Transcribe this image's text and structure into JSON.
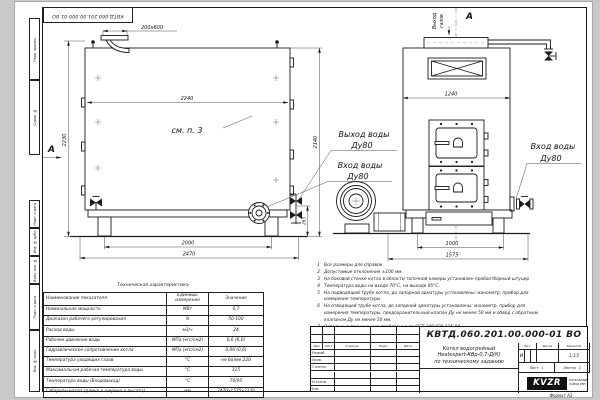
{
  "sheet": {
    "designation_top": "КВТД.060.201.00.000-01 ВО",
    "format_note": "Формат А3",
    "margin_labels": [
      "Перв. примен.",
      "Справ. №",
      "Подп. и дата",
      "Инв. № дубл.",
      "Взам. инв. №",
      "Подп. и дата",
      "Инв. № подл."
    ]
  },
  "side_view": {
    "dim_chimney": "200x600",
    "dim_width": "2240",
    "dim_height": "2230",
    "dim_outlet_height": "2140",
    "dim_valve_height": "263",
    "dim_legs": "2000",
    "dim_length": "2470",
    "see_item": "см. п. 3",
    "view_arrow": "А"
  },
  "front_view": {
    "view_label": "А",
    "gas_out_line1": "Выход",
    "gas_out_line2": "газов",
    "dim_width": "1240",
    "dim_legs": "1000",
    "dim_overall": "1575",
    "label_water_out": "Выход воды",
    "label_water_out_dn": "Ду80",
    "label_water_in": "Вход воды",
    "label_water_in_dn": "Ду80",
    "label_water_in_right": "Вход воды",
    "label_water_in_right_dn": "Ду80"
  },
  "notes": [
    {
      "n": "1",
      "text": "Все размеры для справок"
    },
    {
      "n": "2",
      "text": "Допустимые отклонения ±100 мм."
    },
    {
      "n": "3",
      "text": "На боковой стенке котла в области топочной камеры установлен пробоотборный штуцер"
    },
    {
      "n": "4",
      "text": "Температура воды на входе 70°С, на выходе 95°С."
    },
    {
      "n": "5",
      "text": "На подводящей трубе котла, до запорной арматуры установлены: манометр, прибор для измерения температуры"
    },
    {
      "n": "6",
      "text": "На отводящей трубе котла, до запорной арматуры установлены: манометр, прибор для измерения температуры, предохранительный клапан Ду не менее 50 мм и обвод с обратным клапаном Ду не менее 50 мм."
    },
    {
      "n": "7",
      "text": "Остальные технические требования по ОСТ 108.030.135-84."
    }
  ],
  "table": {
    "title": "Техническая характеристика",
    "headers": [
      "Наименование показателя",
      "Единицы измерения",
      "Значение"
    ],
    "rows": [
      [
        "Номинальная мощность",
        "МВт",
        "0,7"
      ],
      [
        "Диапазон рабочего регулирования",
        "%",
        "50-100"
      ],
      [
        "Расход воды",
        "м3/ч",
        "24"
      ],
      [
        "Рабочее давление воды",
        "МПа (кгс/см2)",
        "0,6 (6,0)"
      ],
      [
        "Гидравлическое сопротивление котла",
        "МПа (кгс/см2)",
        "0,06 (0,6)"
      ],
      [
        "Температура уходящих газов",
        "°С",
        "не более 220"
      ],
      [
        "Максимальная рабочая температура воды",
        "°С",
        "115"
      ],
      [
        "Температура воды (Вход/выход)",
        "°С",
        "70/95"
      ],
      [
        "Габариты котла (длина х ширина х высота)",
        "мм",
        "2470х1575х2230"
      ]
    ]
  },
  "title_block": {
    "designation": "КВТД.060.201.00.000-01 ВО",
    "name_line1": "Котел водогрейный",
    "name_line2": "Heatexpert-КВр-0,7-Д(К)",
    "name_line3": "по техническому заданию",
    "col_izm": "Изм",
    "col_list": "Лист",
    "col_ndoc": "N докум.",
    "col_podp": "Подп.",
    "col_data": "Дата",
    "row_razrab": "Разраб.",
    "row_prov": "Пров.",
    "row_tkontr": "Т.контр.",
    "row_nkontr": "Н.контр.",
    "row_utv": "Утв.",
    "lit_header": "Лит.",
    "mass_header": "Масса",
    "scale_header": "Масштаб",
    "lit_value": "И",
    "scale_value": "1:15",
    "sheet_label": "Лист",
    "sheet_value": "1",
    "sheets_label": "Листов",
    "sheets_value": "2",
    "logo": "KVZR",
    "company_line1": "КОТЕЛЬНЫЙ",
    "company_line2": "ЗАВОД РЭП"
  }
}
